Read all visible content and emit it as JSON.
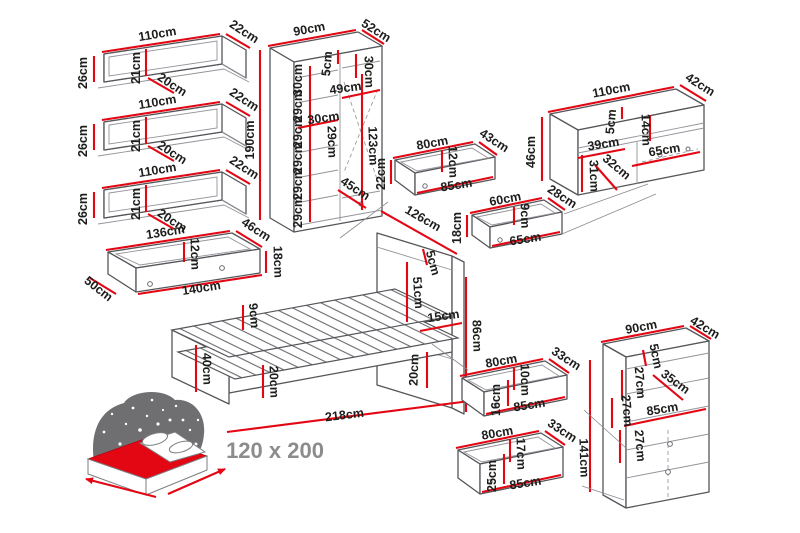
{
  "colors": {
    "dimension_red": "#e30613",
    "outline_gray": "#55565a",
    "label_black": "#1d1d1b",
    "size_text_gray": "#8c8c8c",
    "icon_dark_gray": "#6f6f71"
  },
  "bed_icon": {
    "size_label": "120 x 200"
  },
  "units": {
    "wall_shelf": {
      "width": "110cm",
      "depth": "22cm",
      "height": "26cm",
      "inner_height": "21cm",
      "inner_depth": "20cm"
    },
    "under_shelf_drawer": {
      "inner_width": "136cm",
      "depth": "46cm",
      "inner_height": "12cm",
      "side_height": "18cm",
      "width": "140cm",
      "side_depth": "50cm"
    },
    "wardrobe": {
      "width": "90cm",
      "depth": "52cm",
      "height": "190cm",
      "top_panel": "5cm",
      "right_top_section": "30cm",
      "left_section_width": "49cm",
      "left_mid_width": "30cm",
      "left_sections": [
        "30cm",
        "29cm",
        "29cm",
        "29cm",
        "29cm",
        "29cm"
      ],
      "middle_depth": "29cm",
      "right_section_height": "123cm",
      "bottom_diagonal": "45cm"
    },
    "drawer_80x43": {
      "inner_width": "80cm",
      "depth": "43cm",
      "inner_height": "12cm",
      "width": "85cm",
      "height": "22cm"
    },
    "drawer_60x28": {
      "inner_width": "60cm",
      "depth": "28cm",
      "inner_height": "9cm",
      "width": "65cm",
      "height": "18cm"
    },
    "tv_stand": {
      "width": "110cm",
      "depth": "42cm",
      "height": "46cm",
      "top_panel": "5cm",
      "shelf_height": "14cm",
      "left_width": "39cm",
      "diagonal": "32cm",
      "left_height": "31cm",
      "drawer_width": "65cm"
    },
    "bed": {
      "headboard_width": "126cm",
      "headboard_panel": "5cm",
      "headboard_height": "51cm",
      "ledge": "15cm",
      "total_height": "86cm",
      "frame_height": "9cm",
      "foot_height": "40cm",
      "rail_height": "20cm",
      "back_height": "20cm",
      "length": "218cm"
    },
    "dresser": {
      "width": "90cm",
      "depth": "42cm",
      "height": "141cm",
      "top_panel": "5cm",
      "section_1": "27cm",
      "shelf_depth": "35cm",
      "section_2": "27cm",
      "shelf_width": "85cm",
      "section_3": "27cm"
    },
    "drawer_80x33_small": {
      "inner_width": "80cm",
      "depth": "33cm",
      "inner_height": "10cm",
      "width": "85cm",
      "height": "16cm"
    },
    "drawer_80x33_large": {
      "inner_width": "80cm",
      "depth": "33cm",
      "inner_height": "17cm",
      "width": "85cm",
      "height": "25cm"
    }
  }
}
